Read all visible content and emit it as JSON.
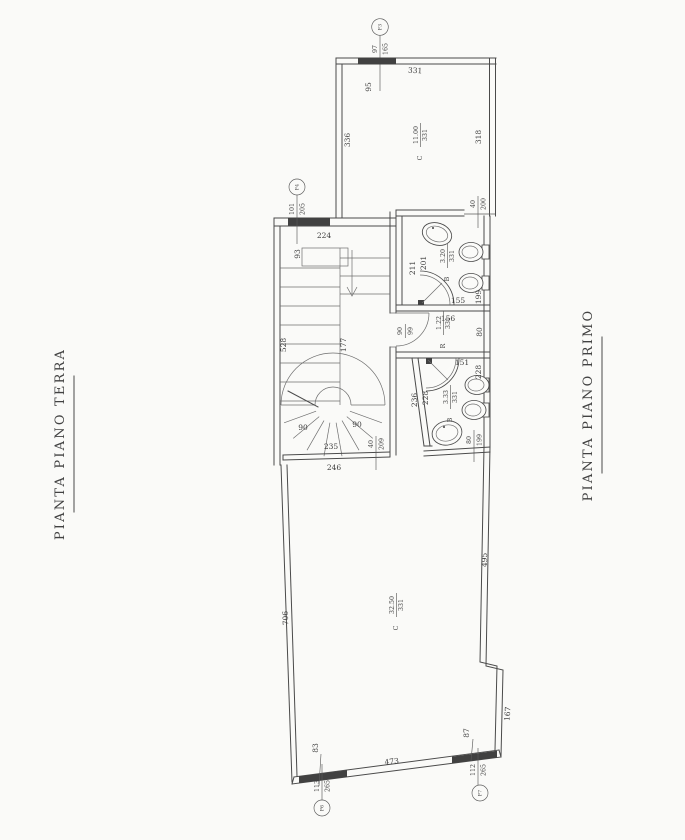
{
  "colors": {
    "ink": "#4a4a4a",
    "paper": "#fafaf8"
  },
  "titles": {
    "left": "PIANTA PIANO TERRA",
    "right": "PIANTA PIANO PRIMO"
  },
  "rooms": {
    "top": {
      "prefix": "C",
      "area": "11.00",
      "height": "331"
    },
    "bath_upper": {
      "prefix": "B",
      "area": "3.20",
      "height": "331"
    },
    "storage": {
      "prefix": "R",
      "area": "1.22",
      "height": "331"
    },
    "bath_lower": {
      "prefix": "B",
      "area": "3.33",
      "height": "331"
    },
    "main": {
      "prefix": "C",
      "area": "32.50",
      "height": "331"
    }
  },
  "openings": {
    "f3": {
      "id": "F3",
      "w": "97",
      "h": "165"
    },
    "f4": {
      "id": "F4",
      "w": "101",
      "h": "205"
    },
    "p6": {
      "id": "P6",
      "w": "113",
      "h": "265"
    },
    "p7": {
      "id": "P7",
      "w": "112",
      "h": "265"
    },
    "door_top": {
      "w": "40",
      "h": "200"
    },
    "door_storage": {
      "w": "90",
      "h": "99"
    },
    "door_hall": {
      "w": "40",
      "h": "209"
    },
    "door_low": {
      "w": "80",
      "h": "199"
    }
  },
  "dims": {
    "top_window": "95",
    "top_wall": "331",
    "top_left": "336",
    "top_right": "318",
    "corridor": "224",
    "corridor_window": "93",
    "bath_up_a": "211",
    "bath_up_b": "201",
    "bath_up_right": "199",
    "bath_up_bottom": "155",
    "storage_top": "156",
    "storage_right": "80",
    "niche": "151",
    "bath_low_right": "228",
    "bath_low_a": "236",
    "bath_low_b": "228",
    "stair_len": "528",
    "stair_void": "177",
    "winder_left": "90",
    "winder_right": "90",
    "winder_width": "235",
    "hall_width": "246",
    "main_left": "706",
    "main_right": "495",
    "main_bottom": "473",
    "main_corner": "167",
    "main_low_right": "87",
    "main_low_left": "83"
  }
}
